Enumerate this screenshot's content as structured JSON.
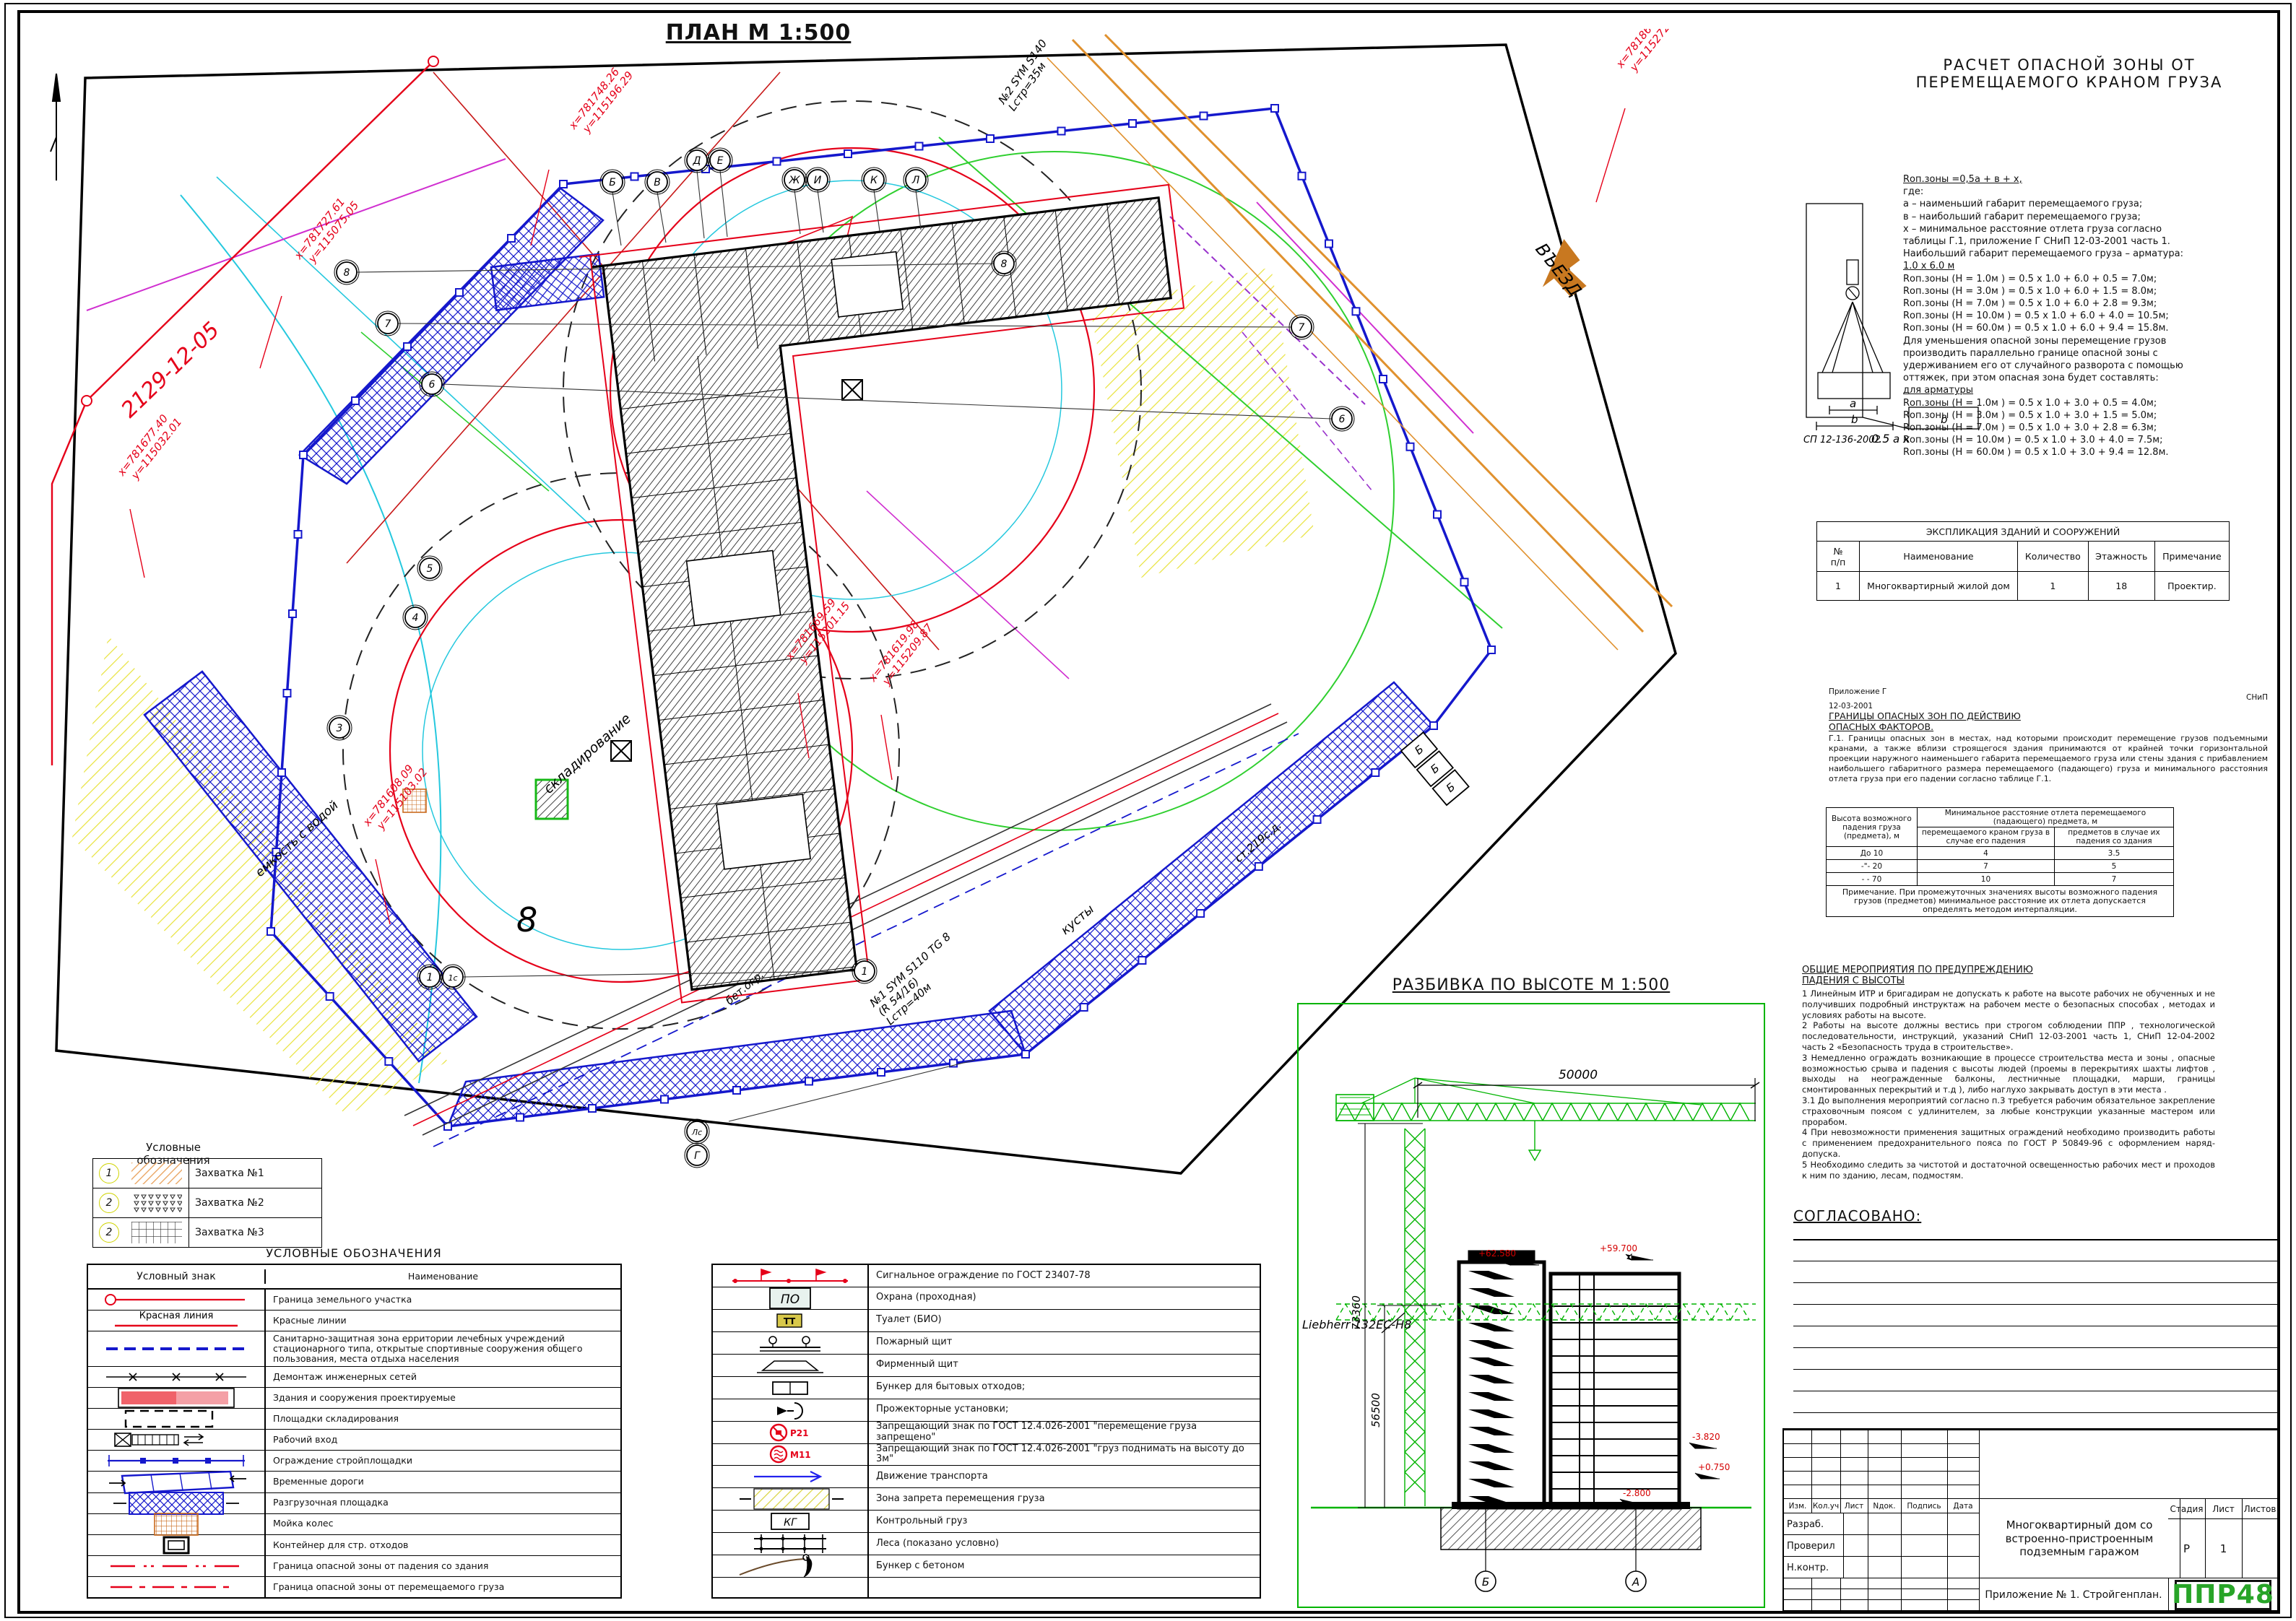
{
  "plan": {
    "title": "ПЛАН М 1:500",
    "road_label": "2129-12-05",
    "bubbles_letters": [
      "Б",
      "В",
      "Д",
      "Е",
      "Ж",
      "И",
      "К",
      "Л"
    ],
    "bubbles_numbers": [
      "8",
      "8",
      "7",
      "7",
      "6",
      "6",
      "5",
      "4",
      "3",
      "1",
      "1с",
      "1",
      "Лс",
      "Г"
    ],
    "big_mark": "8",
    "coords": [
      {
        "x": "х=781748.26",
        "y": "у=115196.29"
      },
      {
        "x": "х=781867.26",
        "y": "у=115272.71"
      },
      {
        "x": "х=781727.61",
        "y": "у=115075.05"
      },
      {
        "x": "х=781677.40",
        "y": "у=115032.01"
      },
      {
        "x": "х=781608.09",
        "y": "у=115103.02"
      },
      {
        "x": "х=781669.59",
        "y": "у=115201.15"
      },
      {
        "x": "х=781619.98",
        "y": "у=115209.87"
      }
    ],
    "labels": {
      "skladirovanie": "складирование",
      "emkost": "емкость с водой",
      "kusty": "кусты",
      "st219": "ст.219с.д.",
      "betogr": "бет.огр.",
      "vyezd": "ВЪЕЗД",
      "crane1": [
        "№1 SYM S110 TG 8",
        "(R 54/16)",
        "Lстр=40м"
      ],
      "crane2": [
        "№2 SYM S140",
        "Lстр=35м"
      ],
      "garage": "Б"
    }
  },
  "zahvatki": {
    "title": "Условные обозначения",
    "rows": [
      {
        "num": "1",
        "sym": "z1",
        "name": "Захватка №1"
      },
      {
        "num": "2",
        "sym": "z2",
        "name": "Захватка №2"
      },
      {
        "num": "2",
        "sym": "z3",
        "name": "Захватка №3"
      }
    ]
  },
  "legend": {
    "title": "УСЛОВНЫЕ ОБОЗНАЧЕНИЯ",
    "col_sym": "Условный знак",
    "col_name": "Наименование",
    "rows": [
      {
        "sym": "border",
        "name": "Граница земельного участка"
      },
      {
        "sym": "redline",
        "name": "Красные линии",
        "symtext": "Красная линия"
      },
      {
        "sym": "sanzone",
        "name": "Санитарно-защитная зона ерритории лечебных учреждений стационарного типа, открытые спортивные сооружения общего пользования, места отдыха населения"
      },
      {
        "sym": "demontage",
        "name": "Демонтаж инженерных сетей"
      },
      {
        "sym": "buildings",
        "name": "Здания и сооружения проектируемые"
      },
      {
        "sym": "storage",
        "name": "Площадки складирования"
      },
      {
        "sym": "entrance",
        "name": "Рабочий вход"
      },
      {
        "sym": "fence",
        "name": "Ограждение стройплощадки"
      },
      {
        "sym": "temproad",
        "name": "Временные дороги"
      },
      {
        "sym": "unload",
        "name": "Разгрузочная площадка"
      },
      {
        "sym": "wash",
        "name": "Мойка колес"
      },
      {
        "sym": "container",
        "name": "Контейнер для стр. отходов"
      },
      {
        "sym": "dzone1",
        "name": "Граница опасной зоны от падения со здания"
      },
      {
        "sym": "dzone2",
        "name": "Граница опасной зоны от перемещаемого груза"
      }
    ]
  },
  "legend2": {
    "rows": [
      {
        "sym": "signal",
        "name": "Сигнальное ограждение по ГОСТ 23407-78"
      },
      {
        "sym": "guard",
        "name": "Охрана (проходная)",
        "symtext": "ПО"
      },
      {
        "sym": "wc",
        "name": "Туалет (БИО)",
        "symtext": "ТТ"
      },
      {
        "sym": "fireshield",
        "name": "Пожарный щит"
      },
      {
        "sym": "brand",
        "name": "Фирменный щит"
      },
      {
        "sym": "bunker",
        "name": "Бункер для бытовых отходов;"
      },
      {
        "sym": "projector",
        "name": "Прожекторные установки;"
      },
      {
        "sym": "signP21",
        "name": "Запрещающий знак  по ГОСТ 12.4.026-2001    \"перемещение груза запрещено\"",
        "symtext": "Р21"
      },
      {
        "sym": "signM11",
        "name": "Запрещающий знак  по ГОСТ 12.4.026-2001    \"груз поднимать на высоту до 3м\"",
        "symtext": "М11"
      },
      {
        "sym": "traffic",
        "name": "Движение транспорта"
      },
      {
        "sym": "banzone",
        "name": "Зона запрета перемещения груза"
      },
      {
        "sym": "testload",
        "name": "Контрольный груз",
        "symtext": "КГ"
      },
      {
        "sym": "scaffold",
        "name": "Леса (показано условно)"
      },
      {
        "sym": "concrete",
        "name": "Бункер с бетоном"
      }
    ]
  },
  "calc": {
    "title1": "РАСЧЕТ ОПАСНОЙ ЗОНЫ ОТ",
    "title2": "ПЕРЕМЕЩАЕМОГО КРАНОМ ГРУЗА",
    "lines": [
      {
        "t": "Rоп.зоны =0,5а + в + х,",
        "u": true
      },
      {
        "t": "где:"
      },
      {
        "t": "а – наименьший габарит перемещаемого груза;"
      },
      {
        "t": "в – наибольший габарит перемещаемого груза;"
      },
      {
        "t": "х – минимальное расстояние отлета груза согласно"
      },
      {
        "t": "таблицы Г.1, приложение Г СНиП 12-03-2001 часть 1."
      },
      {
        "t": "Наибольший  габарит перемещаемого груза – арматура:"
      },
      {
        "t": "1.0 х 6.0 м",
        "u": true
      },
      {
        "t": "Rоп.зоны (Н = 1.0м ) = 0.5 х 1.0 + 6.0 + 0.5 = 7.0м;"
      },
      {
        "t": "Rоп.зоны (Н = 3.0м ) = 0.5 х 1.0 + 6.0 + 1.5 = 8.0м;"
      },
      {
        "t": "Rоп.зоны (Н = 7.0м ) = 0.5 х 1.0 + 6.0 + 2.8 = 9.3м;"
      },
      {
        "t": "Rоп.зоны (Н = 10.0м ) = 0.5 х 1.0 + 6.0 + 4.0 = 10.5м;"
      },
      {
        "t": "Rоп.зоны (Н = 60.0м ) = 0.5 х 1.0 + 6.0 + 9.4 = 15.8м."
      },
      {
        "t": "Для уменьшения опасной зоны перемещение грузов"
      },
      {
        "t": "производить параллельно границе опасной зоны с"
      },
      {
        "t": "удерживанием его от случайного разворота с помощью"
      },
      {
        "t": "оттяжек, при этом опасная зона будет составлять:"
      },
      {
        "t": "для арматуры",
        "u": true
      },
      {
        "t": "Rоп.зоны (Н = 1.0м ) = 0.5 х 1.0 + 3.0 + 0.5 = 4.0м;"
      },
      {
        "t": "Rоп.зоны (Н = 3.0м ) = 0.5 х 1.0 + 3.0 + 1.5 = 5.0м;"
      },
      {
        "t": "Rоп.зоны (Н = 7.0м ) = 0.5 х 1.0 + 3.0 + 2.8 = 6.3м;"
      },
      {
        "t": "Rоп.зоны (Н = 10.0м ) = 0.5 х 1.0 + 3.0 + 4.0 = 7.5м;"
      },
      {
        "t": "Rоп.зоны (Н = 60.0м ) = 0.5 х 1.0 + 3.0 + 9.4 = 12.8м."
      }
    ],
    "diagram": {
      "code": "СП 12-136-2002",
      "d1": "0.5",
      "d2": "a",
      "d3": "x",
      "d4": "b",
      "la": "a",
      "lb": "b"
    }
  },
  "explication": {
    "title": "ЭКСПЛИКАЦИЯ ЗДАНИЙ И СООРУЖЕНИЙ",
    "headers": [
      "№\nп/п",
      "Наименование",
      "Количество",
      "Этажность",
      "Примечание"
    ],
    "rows": [
      [
        "1",
        "Многоквартирный жилой дом",
        "1",
        "18",
        "Проектир."
      ]
    ]
  },
  "appendix": {
    "small1": "Приложение Г",
    "small2": "СНиП",
    "small3": "12-03-2001",
    "head1": "ГРАНИЦЫ  ОПАСНЫХ  ЗОН  ПО ДЕЙСТВИЮ",
    "head2": "ОПАСНЫХ  ФАКТОРОВ.",
    "body": "Г.1.  Границы опасных зон в местах, над которыми происходит перемещение грузов подъемными кранами, а также вблизи строящегося здания принимаются от крайней точки горизонтальной проекции наружного наименьшего габарита перемещаемого груза или стены здания с прибавлением наибольшего габаритного размера перемещаемого (падающего) груза и минимального расстояния отлета груза при его падении согласно  таблице Г.1."
  },
  "table_g1": {
    "h_col1": "Высота возможного\nпадения груза\n(предмета), м",
    "h_top": "Минимальное расстояние отлета перемещаемого\n(падающего) предмета, м",
    "h_sub1": "перемещаемого краном груза в\nслучае его падения",
    "h_sub2": "предметов в случае их\nпадения со здания",
    "rows": [
      [
        "До 10",
        "4",
        "3.5"
      ],
      [
        "-\"- 20",
        "7",
        "5"
      ],
      [
        "- - 70",
        "10",
        "7"
      ]
    ],
    "note": "Примечание. При промежуточных значениях высоты возможного падения грузов (предметов) минимальное расстояние их отлета допускается определять методом интерпаляции."
  },
  "measures": {
    "head1": "ОБЩИЕ  МЕРОПРИЯТИЯ  ПО ПРЕДУПРЕЖДЕНИЮ",
    "head2": "ПАДЕНИЯ  С ВЫСОТЫ",
    "items": [
      "1  Линейным ИТР и бригадирам не допускать к работе на высоте рабочих не обученных   и не получивших подробный инструктаж на рабочем месте о безопасных способах , методах  и условиях работы на высоте.",
      "2  Работы на высоте должны вестись при строгом соблюдении ППР , технологической последовательности, инструкций, указаний СНиП 12-03-2001 часть 1, СНиП 12-04-2002 часть 2 «Безопасность труда в строительстве».",
      "3  Немедленно ограждать возникающие в процессе строительства места и зоны , опасные возможностью срыва и падения с высоты людей  (проемы в перекрытиях шахты лифтов , выходы на неогражденные балконы, лестничные площадки, марши, границы смонтированных перекрытий и т.д ), либо наглухо закрывать доступ в эти места .",
      "3.1 До выполнения мероприятий согласно п.3 требуется рабочим обязательное закрепление страховочным поясом с удлинителем, за любые конструкции указанные мастером  или прорабом.",
      "4  При невозможности применения защитных ограждений необходимо производить работы   с применением предохранительного пояса по ГОСТ Р  50849-96 с оформлением наряд-допуска.",
      "5  Необходимо следить за чистотой и достаточной освещенностью рабочих мест  и проходов к ним по зданию, лесам, подмостям."
    ]
  },
  "soglasovano": {
    "title": "СОГЛАСОВАНО:"
  },
  "elevation": {
    "title": "РАЗБИВКА ПО ВЫСОТЕ М 1:500",
    "dim_top": "50000",
    "dim_v1": "73360",
    "dim_v2": "56500",
    "crane_label": "Liebherr 132EC-H8",
    "mark_roof1": "+62.580",
    "mark_roof2": "+59.700",
    "mark_g1": "-3.820",
    "mark_g2": "+0.750",
    "mark_g3": "-2.800",
    "axis1": "Б",
    "axis2": "А"
  },
  "stamp": {
    "headers": [
      "Изм.",
      "Кол.уч",
      "Лист",
      "Nдок.",
      "Подпись",
      "Дата"
    ],
    "rows": [
      "Разраб.",
      "Проверил",
      "Н.контр."
    ],
    "object": "Многоквартирный дом со встроенно-пристроенным подземным гаражом",
    "stage_label": "Стадия",
    "sheet_label": "Лист",
    "sheets_label": "Листов",
    "stage": "Р",
    "sheet": "1",
    "sheets": "",
    "doc": "Приложение № 1. Стройгенплан.",
    "logo": "ППР48"
  },
  "colors": {
    "blue": "#1518cc",
    "red": "#e50019",
    "orange": "#e0912e",
    "cyan": "#25c8de",
    "green": "#2fcf2f",
    "crane_green": "#00b400",
    "yellow": "#e8e23a",
    "logo_green": "#28a428"
  }
}
